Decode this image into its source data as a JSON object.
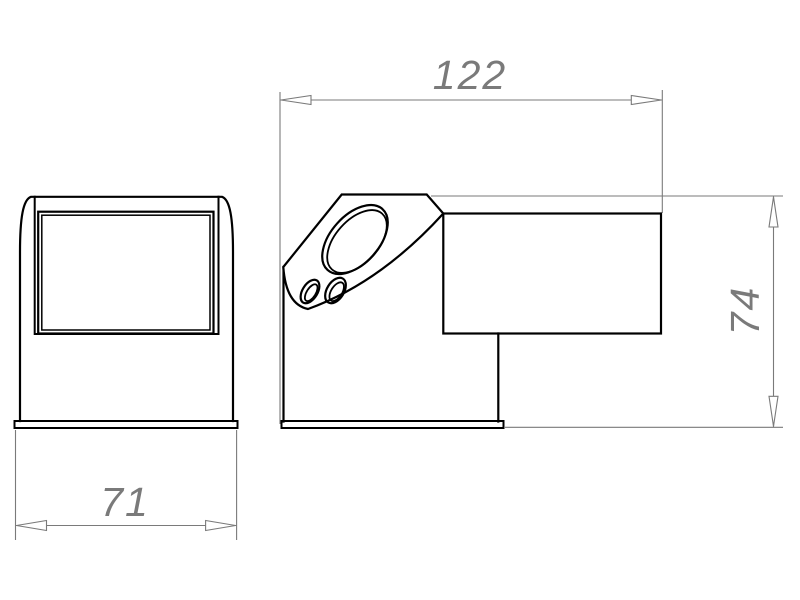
{
  "drawing": {
    "dimensions": {
      "horizontal_top": {
        "value": "122"
      },
      "vertical_right": {
        "value": "74"
      },
      "horizontal_bottom": {
        "value": "71"
      }
    },
    "colors": {
      "background": "#ffffff",
      "outline": "#000000",
      "dimension": "#7a7a7a"
    }
  }
}
